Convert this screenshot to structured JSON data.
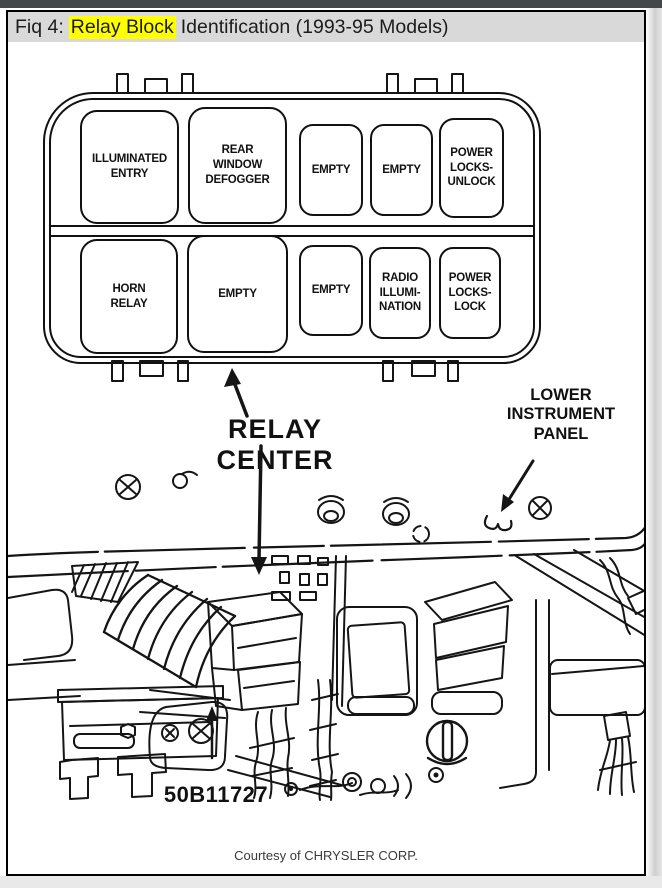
{
  "colors": {
    "top_bar": "#43474b",
    "title_bar_bg": "#d9d9d9",
    "highlight": "#ffff00",
    "ink": "#141414",
    "page_bg": "#ffffff"
  },
  "header": {
    "prefix": "Fiq 4:",
    "highlight": "Relay Block",
    "suffix": "Identification (1993-95 Models)"
  },
  "relay_block": {
    "row1": [
      "ILLUMINATED\nENTRY",
      "REAR\nWINDOW\nDEFOGGER",
      "EMPTY",
      "EMPTY",
      "POWER\nLOCKS-\nUNLOCK"
    ],
    "row2": [
      "HORN\nRELAY",
      "EMPTY",
      "EMPTY",
      "RADIO\nILLUMI-\nNATION",
      "POWER\nLOCKS-\nLOCK"
    ]
  },
  "callouts": {
    "relay_center": "RELAY CENTER",
    "lower_instrument_panel": "LOWER\nINSTRUMENT\nPANEL"
  },
  "figure": {
    "part_number": "50B11727",
    "credit": "Courtesy of CHRYSLER CORP."
  }
}
